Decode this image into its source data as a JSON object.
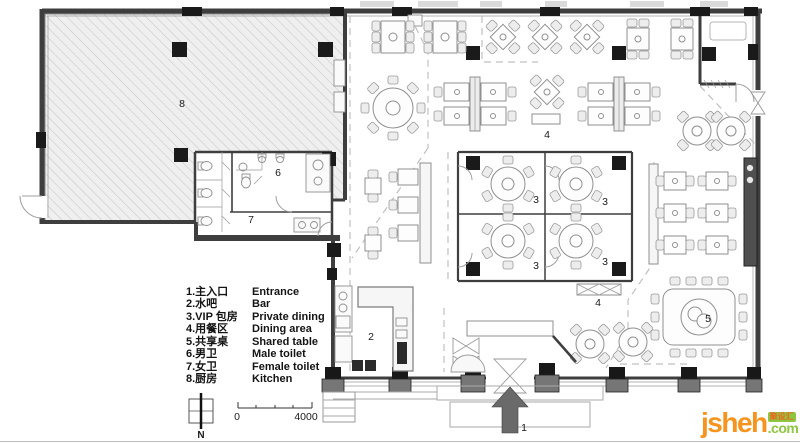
{
  "plan": {
    "room_labels": [
      {
        "area": "kitchen",
        "text": "8"
      },
      {
        "area": "male-toilet",
        "text": "6"
      },
      {
        "area": "female-toilet",
        "text": "7"
      },
      {
        "area": "bar",
        "text": "2"
      },
      {
        "area": "vip-room-1",
        "text": "3"
      },
      {
        "area": "vip-room-2",
        "text": "3"
      },
      {
        "area": "vip-room-3",
        "text": "3"
      },
      {
        "area": "vip-room-4",
        "text": "3"
      },
      {
        "area": "dining-area-upper",
        "text": "4"
      },
      {
        "area": "dining-area-lower",
        "text": "4"
      },
      {
        "area": "shared-table",
        "text": "5"
      },
      {
        "area": "entrance",
        "text": "1"
      }
    ]
  },
  "legend": {
    "items": [
      {
        "cn": "1.主入口",
        "en": "Entrance"
      },
      {
        "cn": "2.水吧",
        "en": "Bar"
      },
      {
        "cn": "3.VIP 包房",
        "en": "Private dining"
      },
      {
        "cn": "4.用餐区",
        "en": "Dining area"
      },
      {
        "cn": "5.共享桌",
        "en": "Shared table"
      },
      {
        "cn": "6.男卫",
        "en": "Male toilet"
      },
      {
        "cn": "7.女卫",
        "en": "Female toilet"
      },
      {
        "cn": "8.厨房",
        "en": "Kitchen"
      }
    ]
  },
  "compass": {
    "label": "N"
  },
  "scale_bar": {
    "start": "0",
    "end": "4000"
  },
  "watermark": {
    "name": "jsheh",
    "badge": "聚设汇",
    "tld": ".com"
  },
  "colors": {
    "wall": "#3e3e3e",
    "hatch_line": "#c6c6c6",
    "dashed_zone": "#c0c0c0",
    "watermark_orange": "#f7941d",
    "watermark_green": "#8dc63f"
  }
}
